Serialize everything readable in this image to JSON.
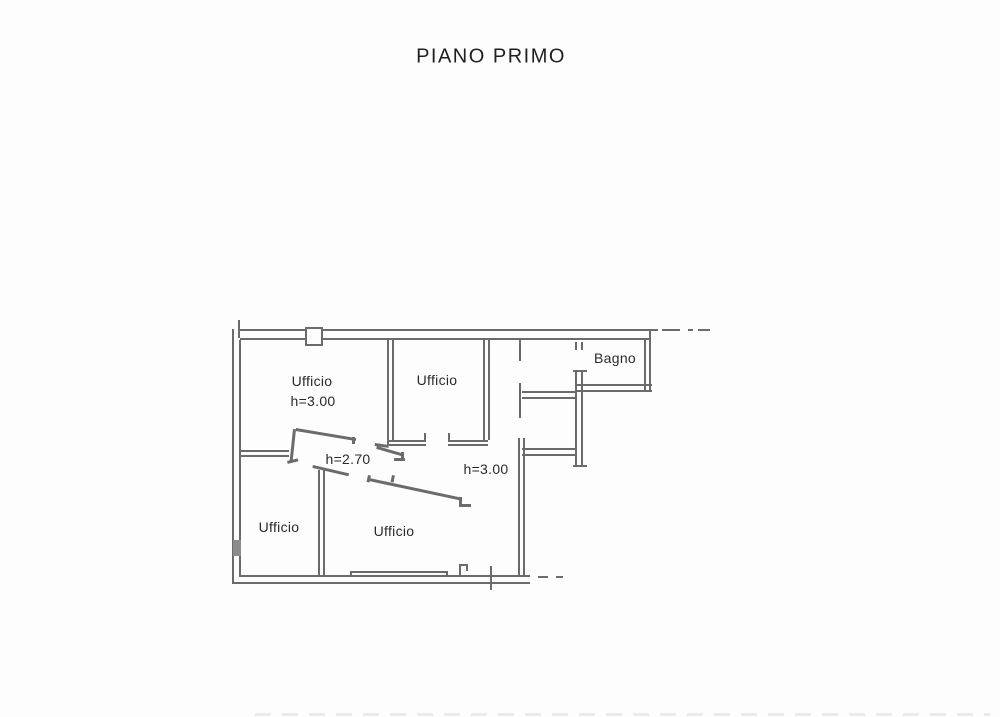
{
  "page": {
    "title": "PIANO PRIMO"
  },
  "plan": {
    "rooms": [
      {
        "id": "ufficio-top-left",
        "label": "Ufficio",
        "height_note": "h=3.00"
      },
      {
        "id": "ufficio-top-middle",
        "label": "Ufficio"
      },
      {
        "id": "bagno",
        "label": "Bagno"
      },
      {
        "id": "ufficio-bottom-left",
        "label": "Ufficio"
      },
      {
        "id": "ufficio-bottom-middle",
        "label": "Ufficio"
      }
    ],
    "height_annotations": [
      {
        "id": "hall-height",
        "text": "h=2.70"
      },
      {
        "id": "main-room-height",
        "text": "h=3.00"
      }
    ],
    "colors": {
      "wall_line": "#6b6b6b",
      "text": "#2a2a2a",
      "background": "#fdfdfd"
    }
  }
}
